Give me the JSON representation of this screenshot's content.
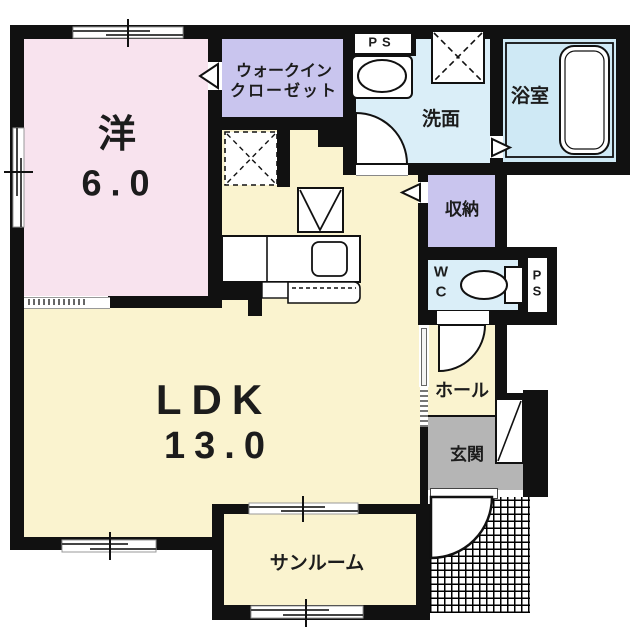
{
  "floorplan": {
    "rooms": {
      "western": {
        "name": "洋",
        "area": "6.0"
      },
      "walk_in_closet": {
        "line1": "ウォークイン",
        "line2": "クローゼット"
      },
      "ps_top": {
        "name": "PS"
      },
      "washroom": {
        "name": "洗面"
      },
      "bathroom": {
        "name": "浴室"
      },
      "storage": {
        "name": "収納"
      },
      "wc": {
        "line1": "W",
        "line2": "C"
      },
      "ps_side": {
        "line1": "P",
        "line2": "S"
      },
      "ldk": {
        "name": "LDK",
        "area": "13.0"
      },
      "hall": {
        "name": "ホール"
      },
      "entrance": {
        "name": "玄関"
      },
      "sunroom": {
        "name": "サンルーム"
      }
    },
    "colors": {
      "wall": "#111111",
      "western_room": "#f8e3ee",
      "closet": "#c9c5ee",
      "storage": "#c9c5ee",
      "ldk": "#faf3cf",
      "hall": "#faf3cf",
      "sunroom": "#faf3cf",
      "washroom": "#daeef8",
      "wc": "#daeef8",
      "bathroom": "#cfe9f5",
      "entrance": "#b5b5b5"
    }
  }
}
